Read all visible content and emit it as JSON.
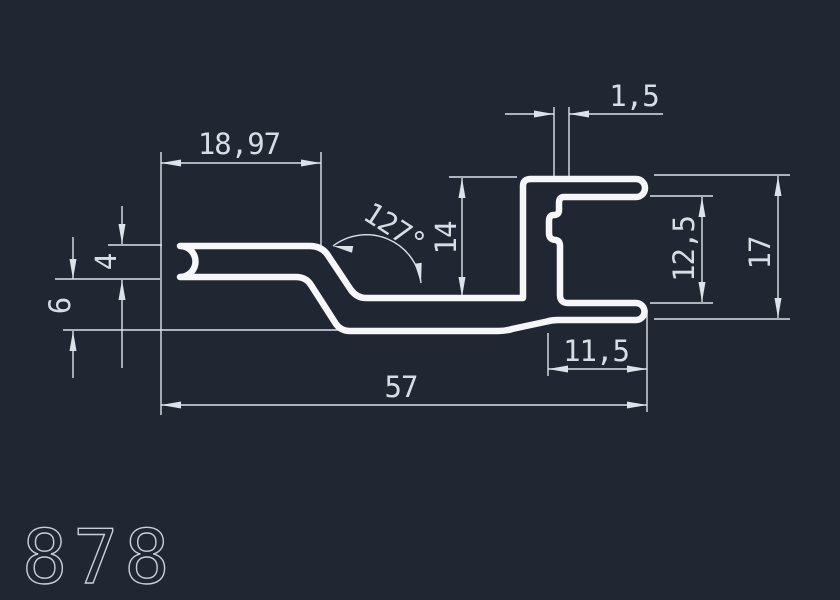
{
  "drawing": {
    "part_number": "878",
    "colors": {
      "background": "#212732",
      "profile": "#f6f7f9",
      "dimension": "#dde1e9",
      "text": "#d8dde5",
      "part_number": "#c9cfd9"
    },
    "dimensions": [
      {
        "name": "top-arm-length",
        "value": "18,97"
      },
      {
        "name": "wall-thickness",
        "value": "1,5"
      },
      {
        "name": "bend-angle",
        "value": "127°"
      },
      {
        "name": "channel-inner-height",
        "value": "14"
      },
      {
        "name": "arm-thickness",
        "value": "4"
      },
      {
        "name": "left-drop-height",
        "value": "6"
      },
      {
        "name": "channel-opening-height",
        "value": "12,5"
      },
      {
        "name": "overall-height",
        "value": "17"
      },
      {
        "name": "tail-length",
        "value": "11,5"
      },
      {
        "name": "overall-width",
        "value": "57"
      }
    ]
  }
}
